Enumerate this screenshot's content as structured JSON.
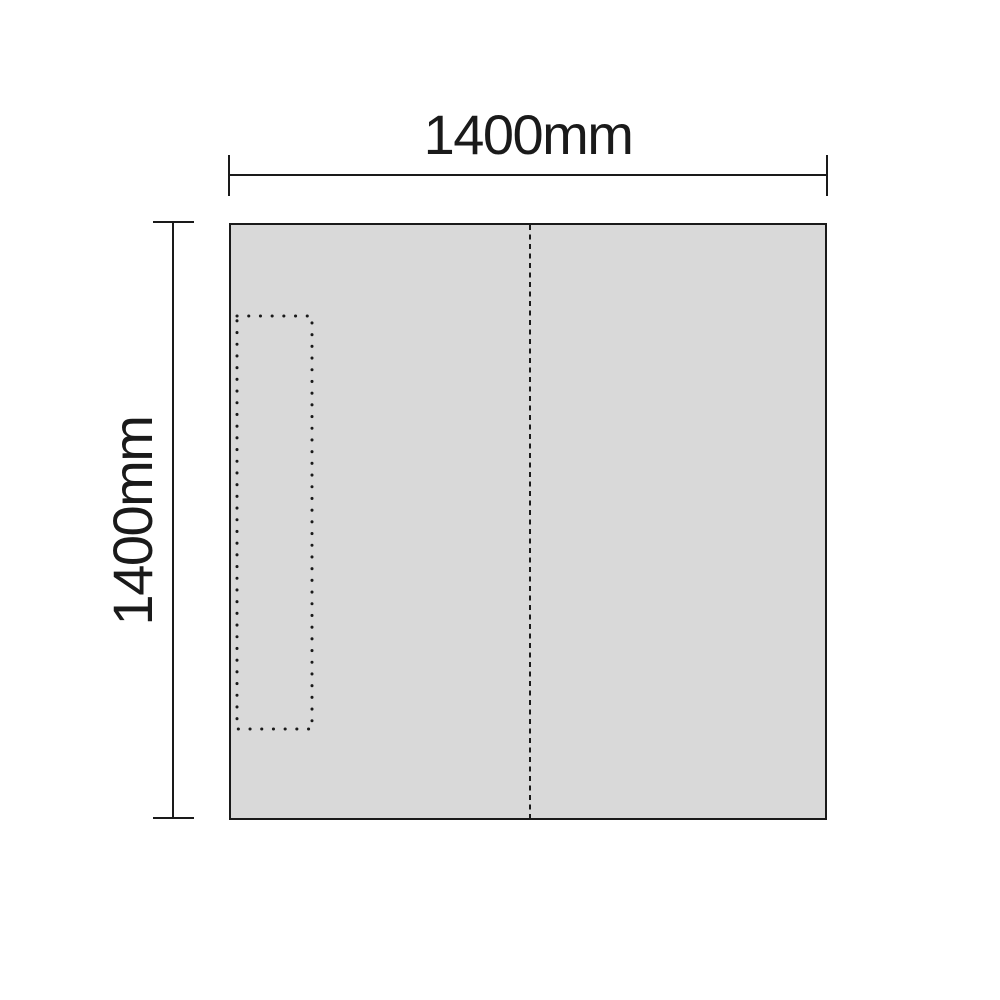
{
  "diagram": {
    "type": "dimensioned-panel-diagram",
    "width_dimension": {
      "label": "1400mm",
      "value_mm": 1400
    },
    "height_dimension": {
      "label": "1400mm",
      "value_mm": 1400
    },
    "panel": {
      "shape": "square",
      "has_dashed_vertical_center_line": true,
      "has_dotted_inner_rectangle_left": true
    },
    "colors": {
      "background": "#ffffff",
      "line": "#1a1a1a",
      "text": "#1a1a1a",
      "panel_fill": "#d9d9d9"
    }
  }
}
